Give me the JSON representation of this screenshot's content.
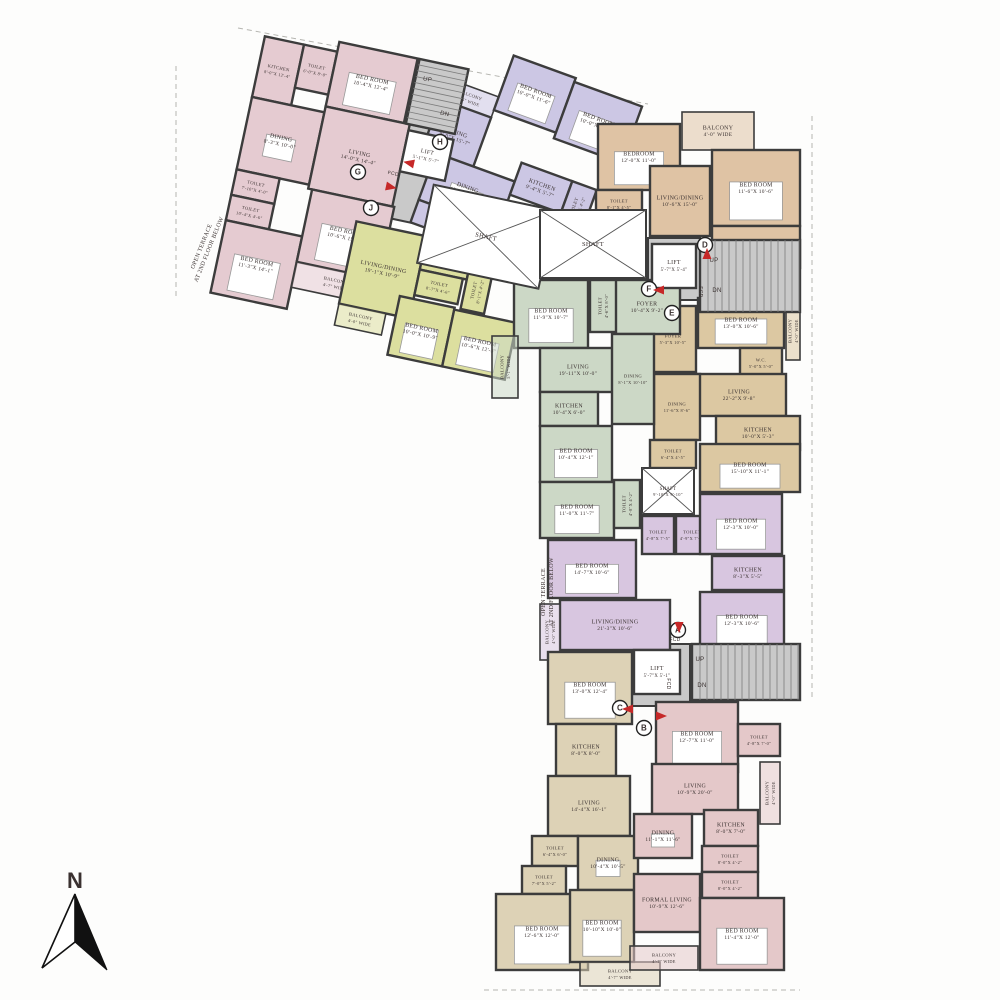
{
  "compass": {
    "label": "N"
  },
  "annotations": [
    {
      "line1": "OPEN TERRACE",
      "line2": "AT 2ND FLOOR BELOW"
    },
    {
      "line1": "OPEN TERRACE",
      "line2": "AT 2ND FLOOR BELOW"
    }
  ],
  "core": {
    "shaft_label": "SHAFT",
    "shaft_small": {
      "name": "SHAFT",
      "dims": "9'-10\"X 9'-10\""
    },
    "lifts": [
      {
        "name": "LIFT",
        "dims": "5'-1\"X 5'-7\""
      },
      {
        "name": "LIFT",
        "dims": "5'-7\"X 5'-4\""
      },
      {
        "name": "LIFT",
        "dims": "5'-7\"X 5'-1\""
      }
    ],
    "stairs": {
      "up": "UP",
      "down": "DN"
    },
    "fcd": "FCD"
  },
  "markers": [
    "G",
    "J",
    "H",
    "D",
    "F",
    "E",
    "A",
    "B",
    "C"
  ],
  "units": [
    {
      "id": "G",
      "color": "#e5cbd1",
      "rooms": [
        {
          "name": "KITCHEN",
          "dims": "8'-0\"X 12'-4\""
        },
        {
          "name": "TOILET",
          "dims": "6'-0\"X 8'-0\""
        },
        {
          "name": "BED ROOM",
          "dims": "10'-4\"X 12'-4\""
        },
        {
          "name": "DINING",
          "dims": "8'-3\"X 10'-0\""
        },
        {
          "name": "LIVING",
          "dims": "14'-0\"X 14'-4\""
        },
        {
          "name": "TOILET",
          "dims": "7'-10\"X 4'-0\""
        },
        {
          "name": "TOILET",
          "dims": "10'-4\"X 4'-6\""
        },
        {
          "name": "BED ROOM",
          "dims": "11'-3\"X 14'-1\""
        },
        {
          "name": "BED ROOM",
          "dims": "10'-6\"X 15'-1\""
        },
        {
          "name": "BALCONY",
          "dims": "4'-7\" WIDE"
        }
      ]
    },
    {
      "id": "H",
      "color": "#ccc7e4",
      "rooms": [
        {
          "name": "BALCONY",
          "dims": "3'-5\" WIDE"
        },
        {
          "name": "LIVING",
          "dims": "9'-0\"X 15'-7\""
        },
        {
          "name": "BED ROOM",
          "dims": "10'-0\"X 11'-6\""
        },
        {
          "name": "BED ROOM",
          "dims": "10'-0\"X 11'-6\""
        },
        {
          "name": "DINING",
          "dims": "13'-0\"X 9'-3\""
        },
        {
          "name": "KITCHEN",
          "dims": "9'-4\"X 5'-7\""
        },
        {
          "name": "TOILET",
          "dims": "9'-0\"X 4'-2\""
        },
        {
          "name": "TOILET",
          "dims": "8'-5\"X 4'-6\""
        }
      ]
    },
    {
      "id": "J",
      "color": "#dcdf9f",
      "rooms": [
        {
          "name": "LIVING/DINING",
          "dims": "19'-1\"X 10'-9\""
        },
        {
          "name": "KITCHEN",
          "dims": "9'-6\"X 5'-3\""
        },
        {
          "name": "TOILET",
          "dims": "8'-7\"X 4'-6\""
        },
        {
          "name": "TOILET",
          "dims": "8'-1\"X 4'-2\""
        },
        {
          "name": "BED ROOM",
          "dims": "10'-0\"X 10'-9\""
        },
        {
          "name": "BED ROOM",
          "dims": "10'-6\"X 12'-3\""
        },
        {
          "name": "BALCONY",
          "dims": "4'-0\" WIDE"
        }
      ]
    },
    {
      "id": "D",
      "color": "#dfc3a4",
      "rooms": [
        {
          "name": "BEDROOM",
          "dims": "12'-0\"X 11'-0\""
        },
        {
          "name": "BALCONY",
          "dims": "4'-0\" WIDE"
        },
        {
          "name": "BED ROOM",
          "dims": "11'-6\"X 10'-6\""
        },
        {
          "name": "LIVING/DINING",
          "dims": "10'-6\"X 15'-0\""
        },
        {
          "name": "TOILET",
          "dims": "8'-1\"X 4'-5\""
        },
        {
          "name": "TOILET",
          "dims": "6'-4\"X 4'-5\""
        },
        {
          "name": "KITCHEN",
          "dims": "11'-6\"X 6'-0\""
        }
      ]
    },
    {
      "id": "E",
      "color": "#dcc8a2",
      "rooms": [
        {
          "name": "FOYER",
          "dims": "5'-3\"X 10'-5\""
        },
        {
          "name": "BED ROOM",
          "dims": "13'-0\"X 10'-6\""
        },
        {
          "name": "BALCONY",
          "dims": "4'-0\" WIDE"
        },
        {
          "name": "W.C.",
          "dims": "5'-0\"X 5'-0\""
        },
        {
          "name": "LIVING",
          "dims": "22'-2\"X 9'-8\""
        },
        {
          "name": "DINING",
          "dims": "11'-6\"X 8'-6\""
        },
        {
          "name": "KITCHEN",
          "dims": "10'-0\"X 5'-3\""
        },
        {
          "name": "TOILET",
          "dims": "6'-4\"X 4'-5\""
        },
        {
          "name": "BED ROOM",
          "dims": "15'-10\"X 11'-1\""
        }
      ]
    },
    {
      "id": "F",
      "color": "#ccd8c6",
      "rooms": [
        {
          "name": "FOYER",
          "dims": "10'-4\"X 9'-2\""
        },
        {
          "name": "BED ROOM",
          "dims": "11'-9\"X 10'-7\""
        },
        {
          "name": "TOILET",
          "dims": "4'-6\"X 8'-0\""
        },
        {
          "name": "BALCONY",
          "dims": "5'-1\" WIDE"
        },
        {
          "name": "LIVING",
          "dims": "19'-11\"X 10'-0\""
        },
        {
          "name": "DINING",
          "dims": "8'-1\"X 10'-10\""
        },
        {
          "name": "KITCHEN",
          "dims": "10'-4\"X 6'-0\""
        },
        {
          "name": "BED ROOM",
          "dims": "10'-4\"X 12'-1\""
        },
        {
          "name": "BED ROOM",
          "dims": "11'-0\"X 11'-7\""
        },
        {
          "name": "TOILET",
          "dims": "4'-8\"X 4'-2\""
        }
      ]
    },
    {
      "id": "A",
      "color": "#d8c6e0",
      "rooms": [
        {
          "name": "BED ROOM",
          "dims": "14'-7\"X 10'-6\""
        },
        {
          "name": "TOILET",
          "dims": "4'-8\"X 7'-5\""
        },
        {
          "name": "TOILET",
          "dims": "4'-9\"X 7'-5\""
        },
        {
          "name": "BED ROOM",
          "dims": "12'-3\"X 10'-0\""
        },
        {
          "name": "KITCHEN",
          "dims": "8'-3\"X 5'-5\""
        },
        {
          "name": "BED ROOM",
          "dims": "12'-3\"X 10'-6\""
        },
        {
          "name": "LIVING/DINING",
          "dims": "21'-3\"X 10'-6\""
        },
        {
          "name": "BALCONY",
          "dims": "4'-0\" WIDE"
        }
      ]
    },
    {
      "id": "C",
      "color": "#ddd2b6",
      "rooms": [
        {
          "name": "BED ROOM",
          "dims": "13'-0\"X 12'-4\""
        },
        {
          "name": "KITCHEN",
          "dims": "8'-0\"X 8'-0\""
        },
        {
          "name": "LIVING",
          "dims": "14'-4\"X 16'-1\""
        },
        {
          "name": "TOILET",
          "dims": "6'-4\"X 6'-0\""
        },
        {
          "name": "DINING",
          "dims": "10'-4\"X 10'-5\""
        },
        {
          "name": "TOILET",
          "dims": "7'-0\"X 5'-2\""
        },
        {
          "name": "BED ROOM",
          "dims": "12'-6\"X 12'-0\""
        },
        {
          "name": "BED ROOM",
          "dims": "10'-10\"X 10'-0\""
        },
        {
          "name": "BALCONY",
          "dims": "4'-7\" WIDE"
        }
      ]
    },
    {
      "id": "B",
      "color": "#e4c8c9",
      "rooms": [
        {
          "name": "BED ROOM",
          "dims": "12'-7\"X 11'-0\""
        },
        {
          "name": "TOILET",
          "dims": "4'-8\"X 7'-0\""
        },
        {
          "name": "LIVING",
          "dims": "10'-9\"X 20'-0\""
        },
        {
          "name": "DINING",
          "dims": "11'-1\"X 11'-6\""
        },
        {
          "name": "FORMAL LIVING",
          "dims": "10'-9\"X 12'-6\""
        },
        {
          "name": "KITCHEN",
          "dims": "8'-0\"X 7'-0\""
        },
        {
          "name": "TOILET",
          "dims": "8'-0\"X 4'-2\""
        },
        {
          "name": "TOILET",
          "dims": "8'-0\"X 4'-2\""
        },
        {
          "name": "BED ROOM",
          "dims": "11'-4\"X 12'-0\""
        },
        {
          "name": "BALCONY",
          "dims": "4'-7\" WIDE"
        },
        {
          "name": "BALCONY",
          "dims": "4'-0\" WIDE"
        }
      ]
    }
  ]
}
